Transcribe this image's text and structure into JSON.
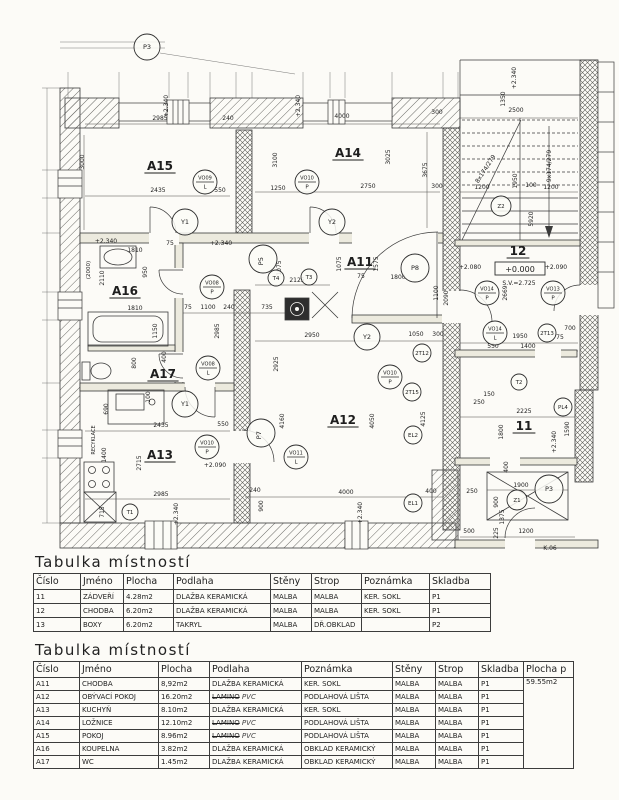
{
  "plan": {
    "rooms": [
      {
        "t": "A15",
        "x": 160,
        "y": 170
      },
      {
        "t": "A14",
        "x": 348,
        "y": 157
      },
      {
        "t": "A16",
        "x": 125,
        "y": 295
      },
      {
        "t": "A17",
        "x": 163,
        "y": 378
      },
      {
        "t": "A11",
        "x": 360,
        "y": 266
      },
      {
        "t": "A12",
        "x": 343,
        "y": 424
      },
      {
        "t": "A13",
        "x": 160,
        "y": 459
      },
      {
        "t": "12",
        "x": 518,
        "y": 255
      },
      {
        "t": "11",
        "x": 524,
        "y": 430
      }
    ],
    "dims": [
      {
        "t": "2985",
        "x": 160,
        "y": 120
      },
      {
        "t": "240",
        "x": 228,
        "y": 120
      },
      {
        "t": "3000",
        "x": 84,
        "y": 162,
        "r": -90
      },
      {
        "t": "3100",
        "x": 277,
        "y": 160,
        "r": -90
      },
      {
        "t": "2435",
        "x": 158,
        "y": 192
      },
      {
        "t": "550",
        "x": 220,
        "y": 192
      },
      {
        "t": "1250",
        "x": 278,
        "y": 190
      },
      {
        "t": "4000",
        "x": 342,
        "y": 118
      },
      {
        "t": "300",
        "x": 437,
        "y": 114
      },
      {
        "t": "3025",
        "x": 390,
        "y": 157,
        "r": -90
      },
      {
        "t": "3675",
        "x": 427,
        "y": 170,
        "r": -90
      },
      {
        "t": "2750",
        "x": 368,
        "y": 188
      },
      {
        "t": "300",
        "x": 437,
        "y": 188
      },
      {
        "t": "1810",
        "x": 135,
        "y": 252
      },
      {
        "t": "75",
        "x": 170,
        "y": 245
      },
      {
        "t": "2110",
        "x": 104,
        "y": 278,
        "r": -90
      },
      {
        "t": "950",
        "x": 147,
        "y": 272,
        "r": -90
      },
      {
        "t": "1810",
        "x": 135,
        "y": 310
      },
      {
        "t": "1150",
        "x": 157,
        "y": 331,
        "r": -90
      },
      {
        "t": "800",
        "x": 136,
        "y": 363,
        "r": -90
      },
      {
        "t": "400",
        "x": 166,
        "y": 357,
        "r": -90
      },
      {
        "t": "75",
        "x": 188,
        "y": 309
      },
      {
        "t": "1100",
        "x": 208,
        "y": 309
      },
      {
        "t": "240",
        "x": 229,
        "y": 309
      },
      {
        "t": "2985",
        "x": 219,
        "y": 331,
        "r": -90
      },
      {
        "t": "735",
        "x": 267,
        "y": 309
      },
      {
        "t": "2125",
        "x": 297,
        "y": 282
      },
      {
        "t": "1075",
        "x": 281,
        "y": 268,
        "r": -90
      },
      {
        "t": "1075",
        "x": 341,
        "y": 264,
        "r": -90
      },
      {
        "t": "1575",
        "x": 378,
        "y": 264,
        "r": -90
      },
      {
        "t": "75",
        "x": 361,
        "y": 278
      },
      {
        "t": "1800",
        "x": 398,
        "y": 279
      },
      {
        "t": "1100",
        "x": 438,
        "y": 293,
        "r": -90
      },
      {
        "t": "2090",
        "x": 448,
        "y": 298,
        "r": -90
      },
      {
        "t": "2950",
        "x": 312,
        "y": 337
      },
      {
        "t": "1050",
        "x": 416,
        "y": 336
      },
      {
        "t": "300",
        "x": 438,
        "y": 336
      },
      {
        "t": "4160",
        "x": 284,
        "y": 421,
        "r": -90
      },
      {
        "t": "4050",
        "x": 374,
        "y": 421,
        "r": -90
      },
      {
        "t": "4125",
        "x": 425,
        "y": 419,
        "r": -90
      },
      {
        "t": "2925",
        "x": 278,
        "y": 364,
        "r": -90
      },
      {
        "t": "4000",
        "x": 346,
        "y": 494
      },
      {
        "t": "400",
        "x": 431,
        "y": 493
      },
      {
        "t": "240",
        "x": 255,
        "y": 492
      },
      {
        "t": "900",
        "x": 263,
        "y": 506,
        "r": -90
      },
      {
        "t": "2435",
        "x": 161,
        "y": 427
      },
      {
        "t": "550",
        "x": 223,
        "y": 426
      },
      {
        "t": "2715",
        "x": 141,
        "y": 463,
        "r": -90
      },
      {
        "t": "2985",
        "x": 161,
        "y": 496
      },
      {
        "t": "715",
        "x": 104,
        "y": 512,
        "r": -90
      },
      {
        "t": "1400",
        "x": 106,
        "y": 455,
        "r": -90
      },
      {
        "t": "690",
        "x": 108,
        "y": 409,
        "r": -90
      },
      {
        "t": "100",
        "x": 150,
        "y": 397,
        "r": -90
      },
      {
        "t": "2500",
        "x": 516,
        "y": 112
      },
      {
        "t": "1350",
        "x": 505,
        "y": 99,
        "r": -90
      },
      {
        "t": "1200",
        "x": 482,
        "y": 189
      },
      {
        "t": "1950",
        "x": 517,
        "y": 181,
        "r": -90
      },
      {
        "t": "100",
        "x": 531,
        "y": 187
      },
      {
        "t": "1200",
        "x": 551,
        "y": 189
      },
      {
        "t": "5920",
        "x": 533,
        "y": 219,
        "r": -90
      },
      {
        "t": "2669",
        "x": 507,
        "y": 293,
        "r": -90
      },
      {
        "t": "1950",
        "x": 520,
        "y": 338
      },
      {
        "t": "1400",
        "x": 528,
        "y": 348
      },
      {
        "t": "550",
        "x": 493,
        "y": 348
      },
      {
        "t": "75",
        "x": 560,
        "y": 339
      },
      {
        "t": "700",
        "x": 570,
        "y": 330
      },
      {
        "t": "2225",
        "x": 524,
        "y": 413
      },
      {
        "t": "1800",
        "x": 503,
        "y": 432,
        "r": -90
      },
      {
        "t": "1590",
        "x": 569,
        "y": 429,
        "r": -90
      },
      {
        "t": "400",
        "x": 508,
        "y": 467,
        "r": -90
      },
      {
        "t": "150",
        "x": 489,
        "y": 396
      },
      {
        "t": "250",
        "x": 479,
        "y": 404
      },
      {
        "t": "1900",
        "x": 521,
        "y": 487
      },
      {
        "t": "900",
        "x": 498,
        "y": 502,
        "r": -90
      },
      {
        "t": "1375",
        "x": 504,
        "y": 517,
        "r": -90
      },
      {
        "t": "225",
        "x": 498,
        "y": 533,
        "r": -90
      },
      {
        "t": "1200",
        "x": 526,
        "y": 533
      },
      {
        "t": "500",
        "x": 469,
        "y": 533
      },
      {
        "t": "250",
        "x": 472,
        "y": 493
      }
    ],
    "levels": [
      {
        "t": "+2.340",
        "x": 168,
        "y": 106,
        "r": -90
      },
      {
        "t": "+2.340",
        "x": 300,
        "y": 106,
        "r": -90
      },
      {
        "t": "+2.340",
        "x": 106,
        "y": 243
      },
      {
        "t": "+2.340",
        "x": 221,
        "y": 245
      },
      {
        "t": "+2.090",
        "x": 215,
        "y": 467
      },
      {
        "t": "+2.340",
        "x": 178,
        "y": 514,
        "r": -90
      },
      {
        "t": "+2.340",
        "x": 362,
        "y": 513,
        "r": -90
      },
      {
        "t": "+2.080",
        "x": 470,
        "y": 269
      },
      {
        "t": "+2.090",
        "x": 556,
        "y": 269
      },
      {
        "t": "+2.340",
        "x": 556,
        "y": 442,
        "r": -90
      },
      {
        "t": "+2.340",
        "x": 516,
        "y": 78,
        "r": -90
      }
    ],
    "notes": [
      {
        "t": "8x174/279",
        "x": 487,
        "y": 170,
        "r": -57,
        "s": 6
      },
      {
        "t": "9x174/279",
        "x": 551,
        "y": 166,
        "r": -90,
        "s": 6
      },
      {
        "t": "+0.000",
        "x": 520,
        "y": 272,
        "s": 8,
        "boxed": true
      },
      {
        "t": "S.V.=2.725",
        "x": 519,
        "y": 285,
        "s": 6
      },
      {
        "t": "RECYKLACE",
        "x": 95,
        "y": 440,
        "r": -90,
        "s": 5
      },
      {
        "t": "K.06",
        "x": 550,
        "y": 550,
        "s": 6
      },
      {
        "t": "(2000)",
        "x": 90,
        "y": 270,
        "r": -90,
        "s": 5.5
      }
    ],
    "markers": [
      {
        "t": "VO09",
        "s": "L",
        "x": 205,
        "y": 182,
        "r": 12
      },
      {
        "t": "VO10",
        "s": "P",
        "x": 307,
        "y": 182,
        "r": 12
      },
      {
        "t": "VO08",
        "s": "P",
        "x": 212,
        "y": 287,
        "r": 12
      },
      {
        "t": "VO08",
        "s": "L",
        "x": 208,
        "y": 368,
        "r": 12
      },
      {
        "t": "VO10",
        "s": "P",
        "x": 207,
        "y": 447,
        "r": 12
      },
      {
        "t": "VO10",
        "s": "P",
        "x": 390,
        "y": 377,
        "r": 12
      },
      {
        "t": "VO11",
        "s": "L",
        "x": 296,
        "y": 457,
        "r": 12
      },
      {
        "t": "VO14",
        "s": "L",
        "x": 495,
        "y": 333,
        "r": 12
      },
      {
        "t": "VO14",
        "s": "P",
        "x": 487,
        "y": 293,
        "r": 12
      },
      {
        "t": "VO13",
        "s": "P",
        "x": 553,
        "y": 293,
        "r": 12
      },
      {
        "t": "Y1",
        "x": 185,
        "y": 222,
        "r": 13
      },
      {
        "t": "Y2",
        "x": 332,
        "y": 222,
        "r": 13
      },
      {
        "t": "Y2",
        "x": 367,
        "y": 337,
        "r": 13
      },
      {
        "t": "Y1",
        "x": 185,
        "y": 404,
        "r": 13
      },
      {
        "t": "P3",
        "x": 147,
        "y": 47,
        "r": 13
      },
      {
        "t": "P5",
        "x": 263,
        "y": 259,
        "r": 14,
        "rot": -90
      },
      {
        "t": "P8",
        "x": 415,
        "y": 268,
        "r": 14
      },
      {
        "t": "P7",
        "x": 261,
        "y": 433,
        "r": 14,
        "rot": -90
      },
      {
        "t": "P3",
        "x": 549,
        "y": 489,
        "r": 14
      },
      {
        "t": "PL4",
        "x": 563,
        "y": 407,
        "r": 9
      },
      {
        "t": "2T12",
        "x": 422,
        "y": 353,
        "r": 9
      },
      {
        "t": "2T15",
        "x": 412,
        "y": 392,
        "r": 9
      },
      {
        "t": "2T13",
        "x": 547,
        "y": 333,
        "r": 9
      },
      {
        "t": "EL2",
        "x": 413,
        "y": 435,
        "r": 9
      },
      {
        "t": "EL1",
        "x": 413,
        "y": 503,
        "r": 9
      },
      {
        "t": "Z1",
        "x": 517,
        "y": 500,
        "r": 10
      },
      {
        "t": "Z2",
        "x": 501,
        "y": 206,
        "r": 10
      },
      {
        "t": "T2",
        "x": 519,
        "y": 382,
        "r": 8
      },
      {
        "t": "T3",
        "x": 309,
        "y": 277,
        "r": 8
      },
      {
        "t": "T4",
        "x": 276,
        "y": 278,
        "r": 8
      },
      {
        "t": "T1",
        "x": 130,
        "y": 512,
        "r": 8
      }
    ]
  },
  "tables": [
    {
      "title": "Tabulka místností",
      "headers": [
        "Číslo",
        "Jméno",
        "Plocha",
        "Podlaha",
        "Stěny",
        "Strop",
        "Poznámka",
        "Skladba"
      ],
      "rows": [
        [
          "11",
          "ZÁDVEŘÍ",
          "4.28m2",
          "DLAŽBA KERAMICKÁ",
          "MALBA",
          "MALBA",
          "KER. SOKL",
          "P1"
        ],
        [
          "12",
          "CHODBA",
          "6.20m2",
          "DLAŽBA KERAMICKÁ",
          "MALBA",
          "MALBA",
          "KER. SOKL",
          "P1"
        ],
        [
          "13",
          "BOXY",
          "6.20m2",
          "TAKRYL",
          "MALBA",
          "DŘ.OBKLAD",
          "",
          "P2"
        ]
      ]
    },
    {
      "title": "Tabulka místností",
      "headers": [
        "Číslo",
        "Jméno",
        "Plocha",
        "Podlaha",
        "Poznámka",
        "Stěny",
        "Strop",
        "Skladba",
        "Plocha p"
      ],
      "merge_last_col": true,
      "rows": [
        [
          "A11",
          "CHODBA",
          "8,92m2",
          "DLAŽBA KERAMICKÁ",
          "KER. SOKL",
          "MALBA",
          "MALBA",
          "P1",
          "59.55m2"
        ],
        [
          "A12",
          "OBÝVACÍ POKOJ",
          "16.20m2",
          {
            "s1": "LAMINO",
            "s2": "PVC"
          },
          "PODLAHOVÁ LIŠTA",
          "MALBA",
          "MALBA",
          "P1",
          null
        ],
        [
          "A13",
          "KUCHYŇ",
          "8.10m2",
          "DLAŽBA KERAMICKÁ",
          "KER. SOKL",
          "MALBA",
          "MALBA",
          "P1",
          null
        ],
        [
          "A14",
          "LOŽNICE",
          "12.10m2",
          {
            "s1": "LAMINO",
            "s2": "PVC"
          },
          "PODLAHOVÁ LIŠTA",
          "MALBA",
          "MALBA",
          "P1",
          null
        ],
        [
          "A15",
          "POKOJ",
          "8.96m2",
          {
            "s1": "LAMINO",
            "s2": "PVC"
          },
          "PODLAHOVÁ LIŠTA",
          "MALBA",
          "MALBA",
          "P1",
          null
        ],
        [
          "A16",
          "KOUPELNA",
          "3.82m2",
          "DLAŽBA KERAMICKÁ",
          "OBKLAD KERAMICKÝ",
          "MALBA",
          "MALBA",
          "P1",
          null
        ],
        [
          "A17",
          "WC",
          "1.45m2",
          "DLAŽBA KERAMICKÁ",
          "OBKLAD KERAMICKÝ",
          "MALBA",
          "MALBA",
          "P1",
          null
        ]
      ]
    }
  ]
}
